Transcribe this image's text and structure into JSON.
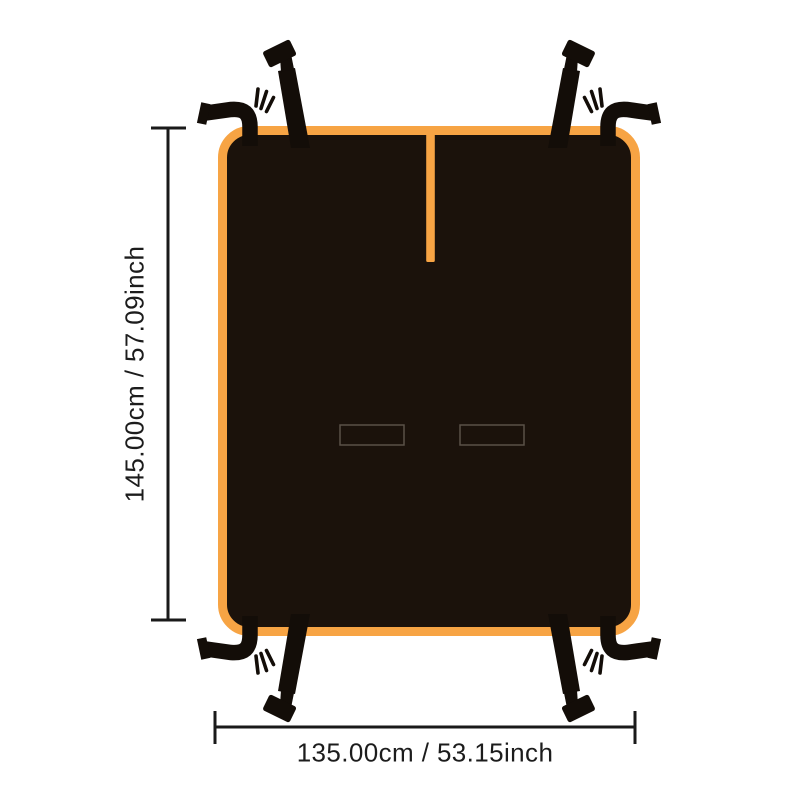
{
  "diagram": {
    "height_dimension": {
      "label": "145.00cm / 57.09inch"
    },
    "width_dimension": {
      "label": "135.00cm / 53.15inch"
    },
    "colors": {
      "background": "#ffffff",
      "trim_orange": "#F7A444",
      "cover_black": "#1B120B",
      "strap_black": "#130D08",
      "slot_outline": "#5a5148",
      "dimension_line": "#1a1a1a",
      "label_text": "#1c1c1c"
    },
    "parts": {
      "cover": "seat-cover-body",
      "slit": "center-slit",
      "slot_left": "seat-belt-slot-left",
      "slot_right": "seat-belt-slot-right",
      "strap_buckle": "buckle-strap",
      "strap_hook": "hook-strap",
      "prongs": "fork-prongs"
    }
  }
}
